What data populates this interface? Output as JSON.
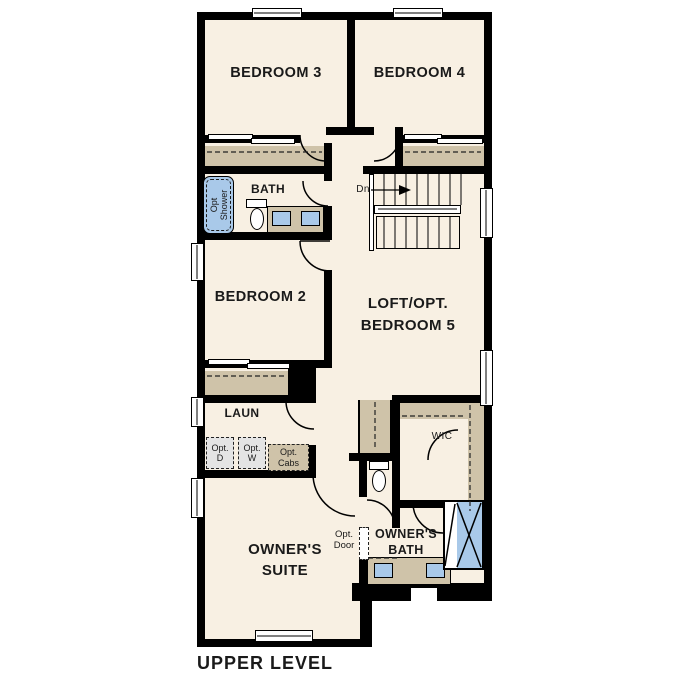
{
  "plan": {
    "title": "UPPER LEVEL",
    "rooms": {
      "bedroom3": "BEDROOM 3",
      "bedroom4": "BEDROOM 4",
      "bath": "BATH",
      "bedroom2": "BEDROOM 2",
      "loft_line1": "LOFT/OPT.",
      "loft_line2": "BEDROOM 5",
      "laundry": "LAUN",
      "wic": "WIC",
      "owners_suite_line1": "OWNER'S",
      "owners_suite_line2": "SUITE",
      "owners_bath_line1": "OWNER'S",
      "owners_bath_line2": "BATH"
    },
    "annotations": {
      "stairs_down": "Dn",
      "opt_shower_line1": "Opt",
      "opt_shower_line2": "Shower",
      "opt_dryer_line1": "Opt.",
      "opt_dryer_line2": "D",
      "opt_washer_line1": "Opt.",
      "opt_washer_line2": "W",
      "opt_cabs_line1": "Opt.",
      "opt_cabs_line2": "Cabs",
      "opt_door_line1": "Opt.",
      "opt_door_line2": "Door"
    },
    "colors": {
      "floor": "#f8f0e3",
      "wall": "#000000",
      "casework": "#cfc3a9",
      "fixture_blue": "#a9c9e9",
      "appliance_gray": "#e4e4e4"
    }
  }
}
